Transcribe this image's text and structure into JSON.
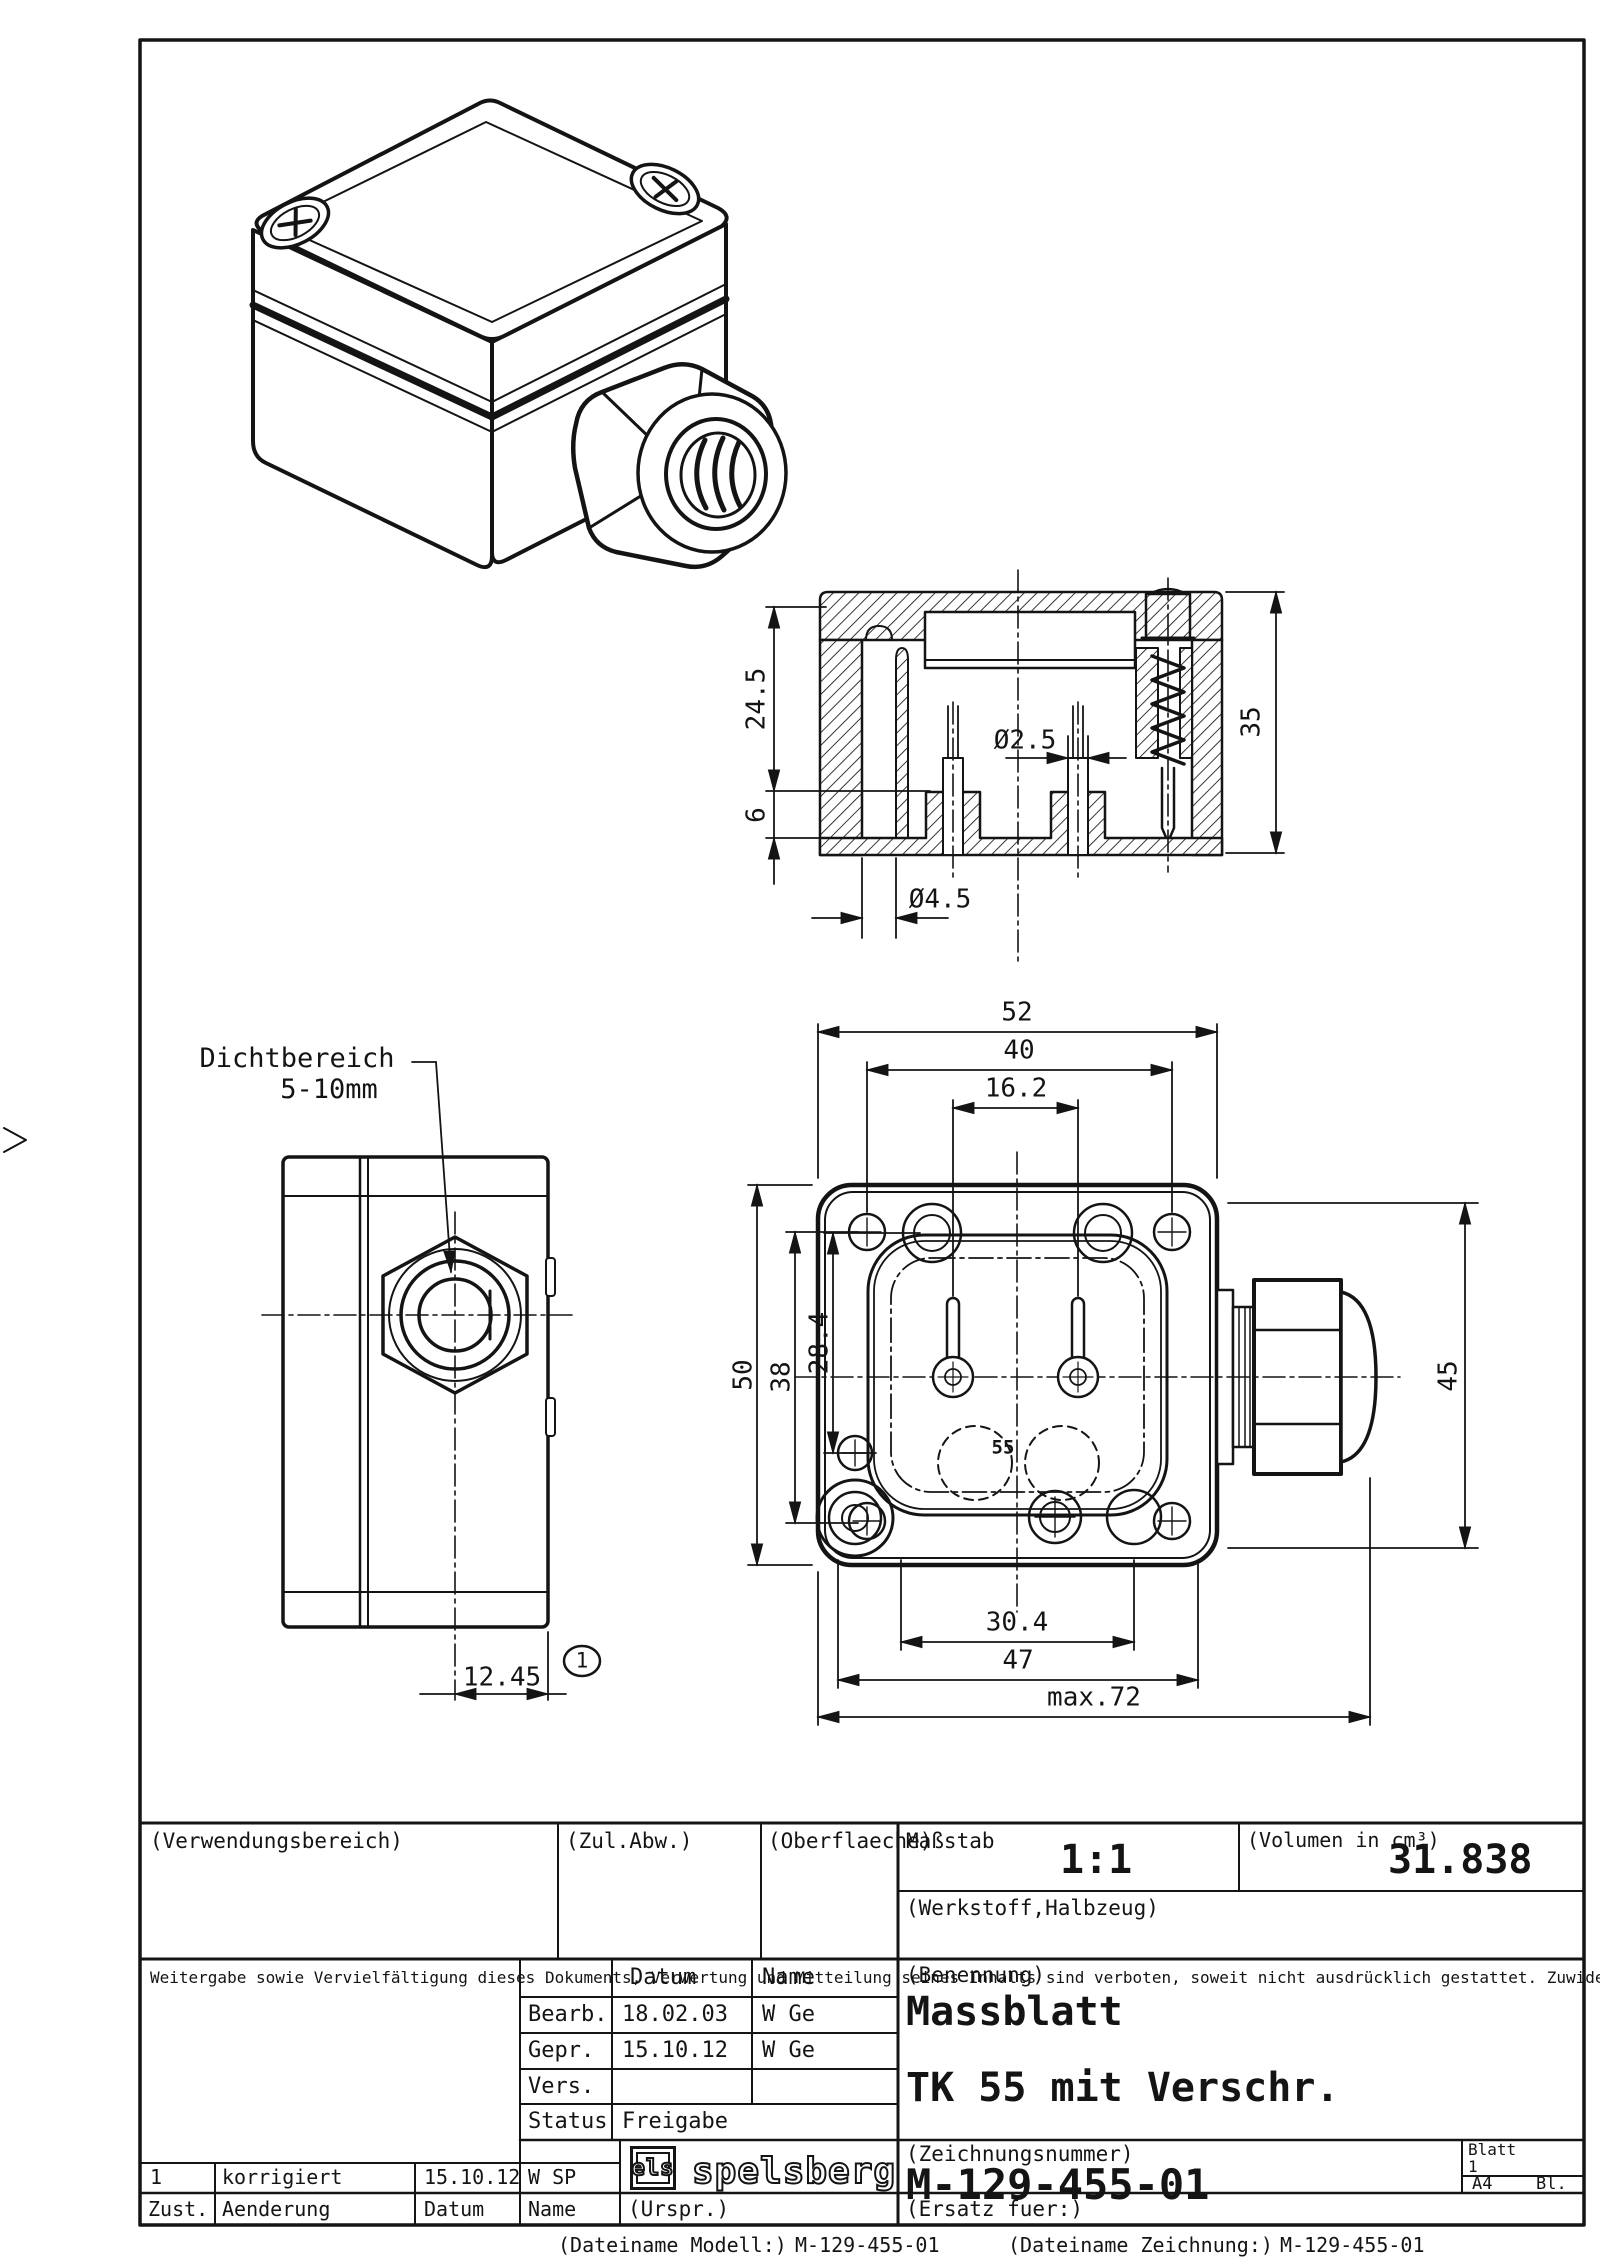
{
  "drawing": {
    "section": {
      "dim_24_5": "24.5",
      "dim_6": "6",
      "dim_dia2_5": "Ø2.5",
      "dim_35": "35",
      "dim_dia4_5": "Ø4.5"
    },
    "side": {
      "callout_line1": "Dichtbereich",
      "callout_line2": "5-10mm",
      "dim_12_45": "12.45",
      "balloon": "1"
    },
    "plan": {
      "dim_52": "52",
      "dim_40": "40",
      "dim_16_2": "16.2",
      "dim_50": "50",
      "dim_38": "38",
      "dim_28_4": "28.4",
      "dim_30_4": "30.4",
      "dim_47": "47",
      "dim_max72": "max.72",
      "dim_45": "45",
      "mold_mark": "55"
    }
  },
  "titleblock": {
    "verwendungsbereich_label": "(Verwendungsbereich)",
    "zul_abw_label": "(Zul.Abw.)",
    "oberflaeche_label": "(Oberflaeche)",
    "massstab_label": "Maßstab",
    "massstab_value": "1:1",
    "volumen_label": "(Volumen in cm³)",
    "volumen_value": "31.838",
    "werkstoff_label": "(Werkstoff,Halbzeug)",
    "legal_text": "Weitergabe sowie Vervielfältigung dieses Dokuments, Verwertung und Mitteilung seines Inhalts sind verboten, soweit nicht ausdrücklich gestattet. Zuwiderhandlungen verpflichten zu Schadenersatz. Alle Rechte für den Fall der Patent-, Gebrauchsmuster- oder Geschmacksmustereintragung vorbehalten.",
    "col_datum": "Datum",
    "col_name": "Name",
    "row_bearb_label": "Bearb.",
    "row_bearb_datum": "18.02.03",
    "row_bearb_name": "W Ge",
    "row_gepr_label": "Gepr.",
    "row_gepr_datum": "15.10.12",
    "row_gepr_name": "W Ge",
    "row_vers_label": "Vers.",
    "status_label": "Status",
    "status_value": "Freigabe",
    "benennung_label": "(Benennung)",
    "benennung_line1": "Massblatt",
    "benennung_line2": "TK 55 mit Verschr.",
    "zeichnungsnummer_label": "(Zeichnungsnummer)",
    "zeichnungsnummer_value": "M-129-455-01",
    "blatt_label": "Blatt",
    "blatt_value": "1",
    "format_value": "A4",
    "bl_label": "Bl.",
    "ersatz_label": "(Ersatz fuer:)",
    "urspr_label": "(Urspr.)",
    "rev_zust": "1",
    "rev_aenderung": "korrigiert",
    "rev_datum": "15.10.12",
    "rev_name": "W SP",
    "revh_zust": "Zust.",
    "revh_aenderung": "Aenderung",
    "revh_datum": "Datum",
    "revh_name": "Name",
    "logo_els": "els",
    "logo_brand": "spelsberg"
  },
  "footer": {
    "filename_model_label": "(Dateiname Modell:)",
    "filename_model": "M-129-455-01",
    "filename_drawing_label": "(Dateiname Zeichnung:)",
    "filename_drawing": "M-129-455-01"
  }
}
